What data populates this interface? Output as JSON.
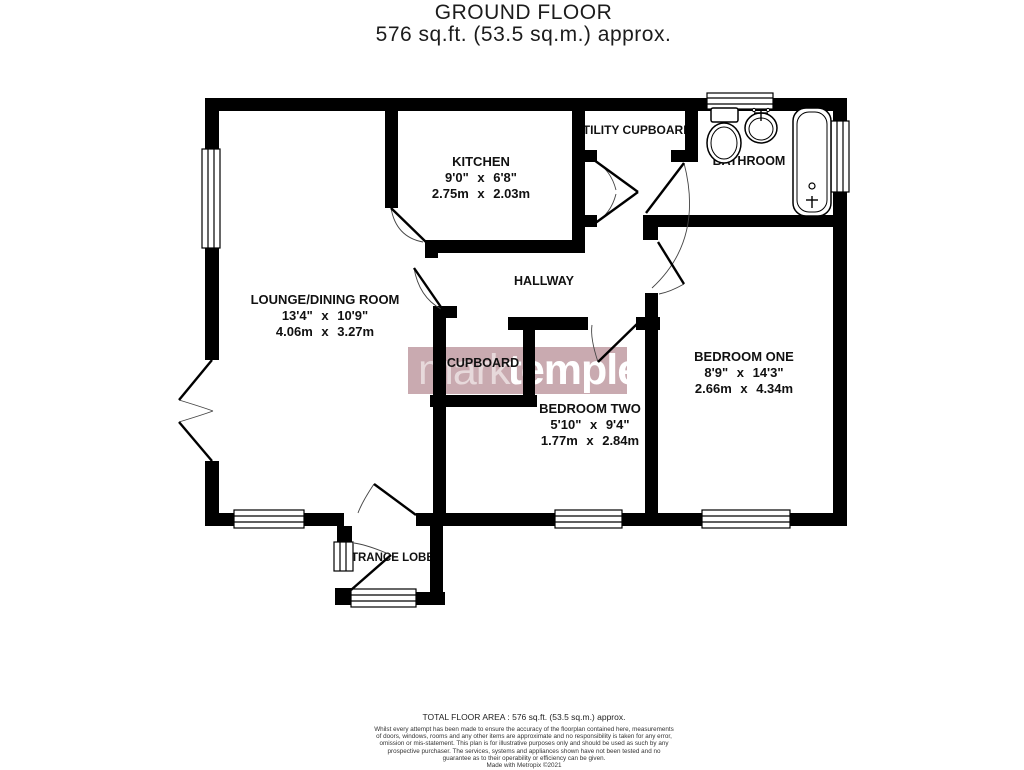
{
  "title": {
    "line1": "GROUND FLOOR",
    "line2": "576 sq.ft. (53.5 sq.m.) approx."
  },
  "rooms": {
    "kitchen": {
      "name": "KITCHEN",
      "imperial": "9'0\" x 6'8\"",
      "metric": "2.75m x 2.03m"
    },
    "utility": {
      "name": "UTILITY CUPBOARD"
    },
    "bathroom": {
      "name": "BATHROOM"
    },
    "lounge": {
      "name": "LOUNGE/DINING ROOM",
      "imperial": "13'4\" x 10'9\"",
      "metric": "4.06m x 3.27m"
    },
    "hallway": {
      "name": "HALLWAY"
    },
    "cupboard": {
      "name": "CUPBOARD"
    },
    "bedroom_one": {
      "name": "BEDROOM ONE",
      "imperial": "8'9\" x 14'3\"",
      "metric": "2.66m x 4.34m"
    },
    "bedroom_two": {
      "name": "BEDROOM TWO",
      "imperial": "5'10\" x 9'4\"",
      "metric": "1.77m x 2.84m"
    },
    "entrance": {
      "name": "ENTRANCE LOBBY"
    }
  },
  "watermark": {
    "part1": "mark",
    "part2": "templer",
    "band_color": "#c9aab0"
  },
  "footer": {
    "area": "TOTAL FLOOR AREA : 576 sq.ft. (53.5 sq.m.) approx.",
    "disclaimer": "Whilst every attempt has been made to ensure the accuracy of the floorplan contained here, measurements of doors, windows, rooms and any other items are approximate and no responsibility is taken for any error, omission or mis-statement. This plan is for illustrative purposes only and should be used as such by any prospective purchaser. The services, systems and appliances shown have not been tested and no guarantee as to their operability or efficiency can be given.",
    "credit": "Made with Metropix ©2021"
  },
  "colors": {
    "wall": "#000000",
    "label": "#111111",
    "watermark_text": "#ffffff"
  }
}
